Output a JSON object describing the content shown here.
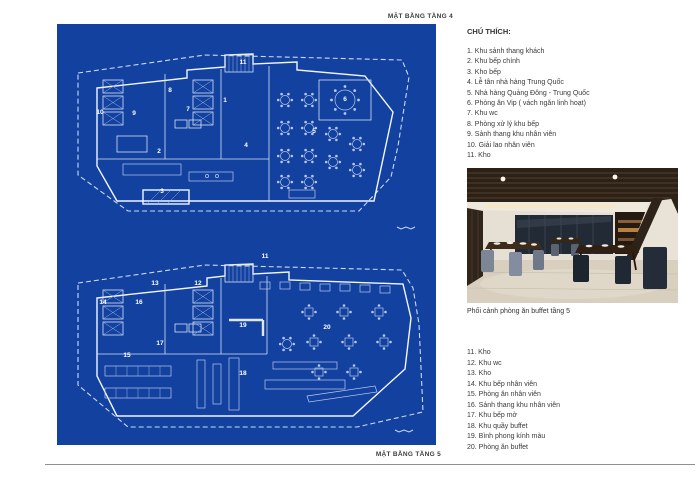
{
  "page": {
    "plan_top_label": "MẶT BẰNG TẦNG 4",
    "plan_bottom_label": "MẶT BẰNG TẦNG 5",
    "legend_title": "CHÚ THÍCH:",
    "photo_caption": "Phối cảnh phòng ăn buffet tầng 5"
  },
  "legend": {
    "floor4_items": [
      "1. Khu sảnh thang khách",
      "2. Khu bếp chính",
      "3. Kho bếp",
      "4. Lễ tân nhà hàng Trung Quốc",
      "5. Nhà hàng Quảng Đông - Trung Quốc",
      "6. Phòng ăn Vip ( vách ngăn linh hoạt)",
      "7. Khu wc",
      "8. Phòng xử lý khu bếp",
      "9. Sảnh thang khu nhân viên",
      "10. Giải lao nhân viên",
      "11. Kho"
    ],
    "floor5_items": [
      "11. Kho",
      "12. Khu wc",
      "13. Kho",
      "14. Khu bếp nhân viên",
      "15. Phòng ăn nhân viên",
      "16. Sảnh thang khu nhân viên",
      "17. Khu bếp mở",
      "18. Khu quầy buffet",
      "19. Bình phong kính màu",
      "20. Phòng ăn buffet"
    ]
  },
  "plan_top": {
    "numbers": [
      {
        "n": "1",
        "x": 168,
        "y": 78
      },
      {
        "n": "2",
        "x": 102,
        "y": 129
      },
      {
        "n": "3",
        "x": 105,
        "y": 169
      },
      {
        "n": "4",
        "x": 189,
        "y": 123
      },
      {
        "n": "5",
        "x": 257,
        "y": 109
      },
      {
        "n": "6",
        "x": 288,
        "y": 77
      },
      {
        "n": "7",
        "x": 131,
        "y": 87
      },
      {
        "n": "8",
        "x": 113,
        "y": 68
      },
      {
        "n": "9",
        "x": 77,
        "y": 91
      },
      {
        "n": "10",
        "x": 43,
        "y": 90
      },
      {
        "n": "11",
        "x": 186,
        "y": 40
      }
    ]
  },
  "plan_bottom": {
    "numbers": [
      {
        "n": "11",
        "x": 208,
        "y": 234
      },
      {
        "n": "12",
        "x": 141,
        "y": 261
      },
      {
        "n": "13",
        "x": 98,
        "y": 261
      },
      {
        "n": "14",
        "x": 46,
        "y": 280
      },
      {
        "n": "15",
        "x": 70,
        "y": 333
      },
      {
        "n": "16",
        "x": 82,
        "y": 280
      },
      {
        "n": "17",
        "x": 103,
        "y": 321
      },
      {
        "n": "18",
        "x": 186,
        "y": 351
      },
      {
        "n": "19",
        "x": 186,
        "y": 303
      },
      {
        "n": "20",
        "x": 270,
        "y": 305
      }
    ]
  },
  "colors": {
    "blueprint_bg": "#1241a0",
    "blueprint_line": "#f2f6fd",
    "boundary_dash": "#ccd9f2",
    "page_bg": "#ffffff",
    "text": "#3a3a3a",
    "divider": "#909090"
  }
}
